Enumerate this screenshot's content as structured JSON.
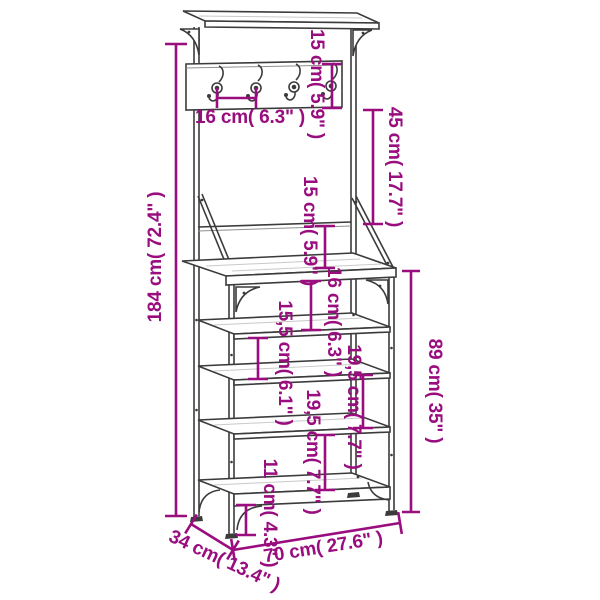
{
  "diagram": {
    "type": "product-dimension-diagram",
    "subject": "clothes rack with shoe storage bench and coat hooks",
    "background": "#ffffff",
    "accent_color": "#990d7f",
    "outline_color": "#3b3b3b",
    "hook_count": 4,
    "shelf_count": 5,
    "dimensions": {
      "total_height": "184 cm( 72.4\" )",
      "hook_panel_height": "15 cm( 5.9\" )",
      "hook_spacing": "16 cm( 6.3\" )",
      "panel_to_backrail": "45 cm( 17.7\" )",
      "backrail_to_tabletop": "15 cm( 5.9\" )",
      "tabletop_to_shelf": "16 cm( 6.3\" )",
      "shelf_gap_upper": "15,5 cm( 6.1\" )",
      "shelf_gap_middle": "19,5 cm( 7.7\" )",
      "shelf_gap_lower": "19,5 cm( 7.7\" )",
      "ground_clearance": "11 cm( 4.3\" )",
      "bench_height": "89 cm( 35\" )",
      "width": "70 cm( 27.6\" )",
      "depth": "34 cm( 13.4\" )"
    }
  }
}
